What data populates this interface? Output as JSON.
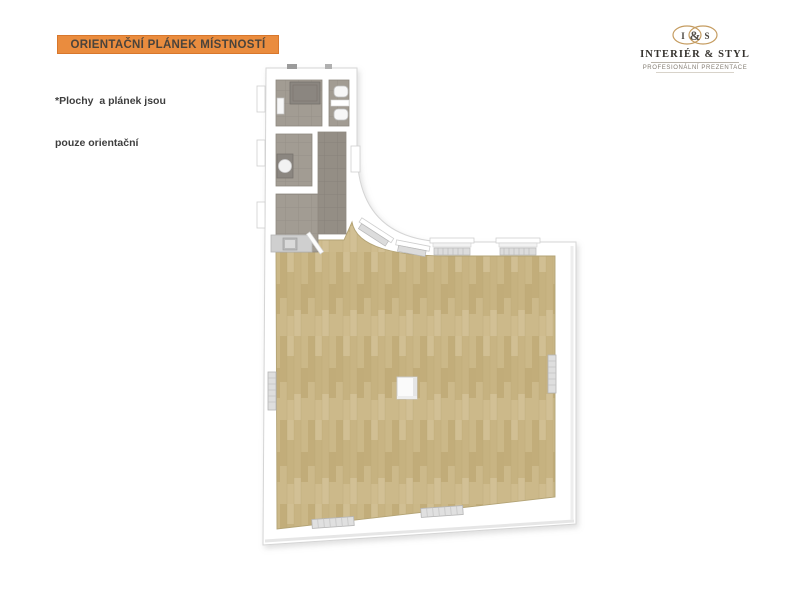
{
  "banner": {
    "label": "ORIENTAČNÍ PLÁNEK MÍSTNOSTÍ"
  },
  "note": {
    "line1": "*Plochy  a plánek jsou",
    "line2": "pouze orientační"
  },
  "logo": {
    "monogram_left": "I",
    "monogram_amp": "&",
    "monogram_right": "S",
    "name": "INTERIÉR & STYL",
    "tagline": "PROFESIONÁLNÍ PREZENTACE"
  },
  "colors": {
    "banner_bg": "#ea8c3e",
    "banner_border": "#d8772c",
    "banner_text": "#4a433b",
    "note_text": "#3e3e3e",
    "logo_accent": "#c59c60",
    "logo_text": "#35322d",
    "logo_tagline": "#837c72",
    "wall": "#ffffff",
    "wall_edge": "#d5d5d5",
    "wood_floor": "#cab687",
    "tile_floor": "#a29c93",
    "corridor_floor": "#948e85",
    "shower": "#8b8680",
    "fixture_white": "#f7f7f7",
    "radiator": "#dcdcdc",
    "kitchen_counter": "#cfcfcf"
  }
}
